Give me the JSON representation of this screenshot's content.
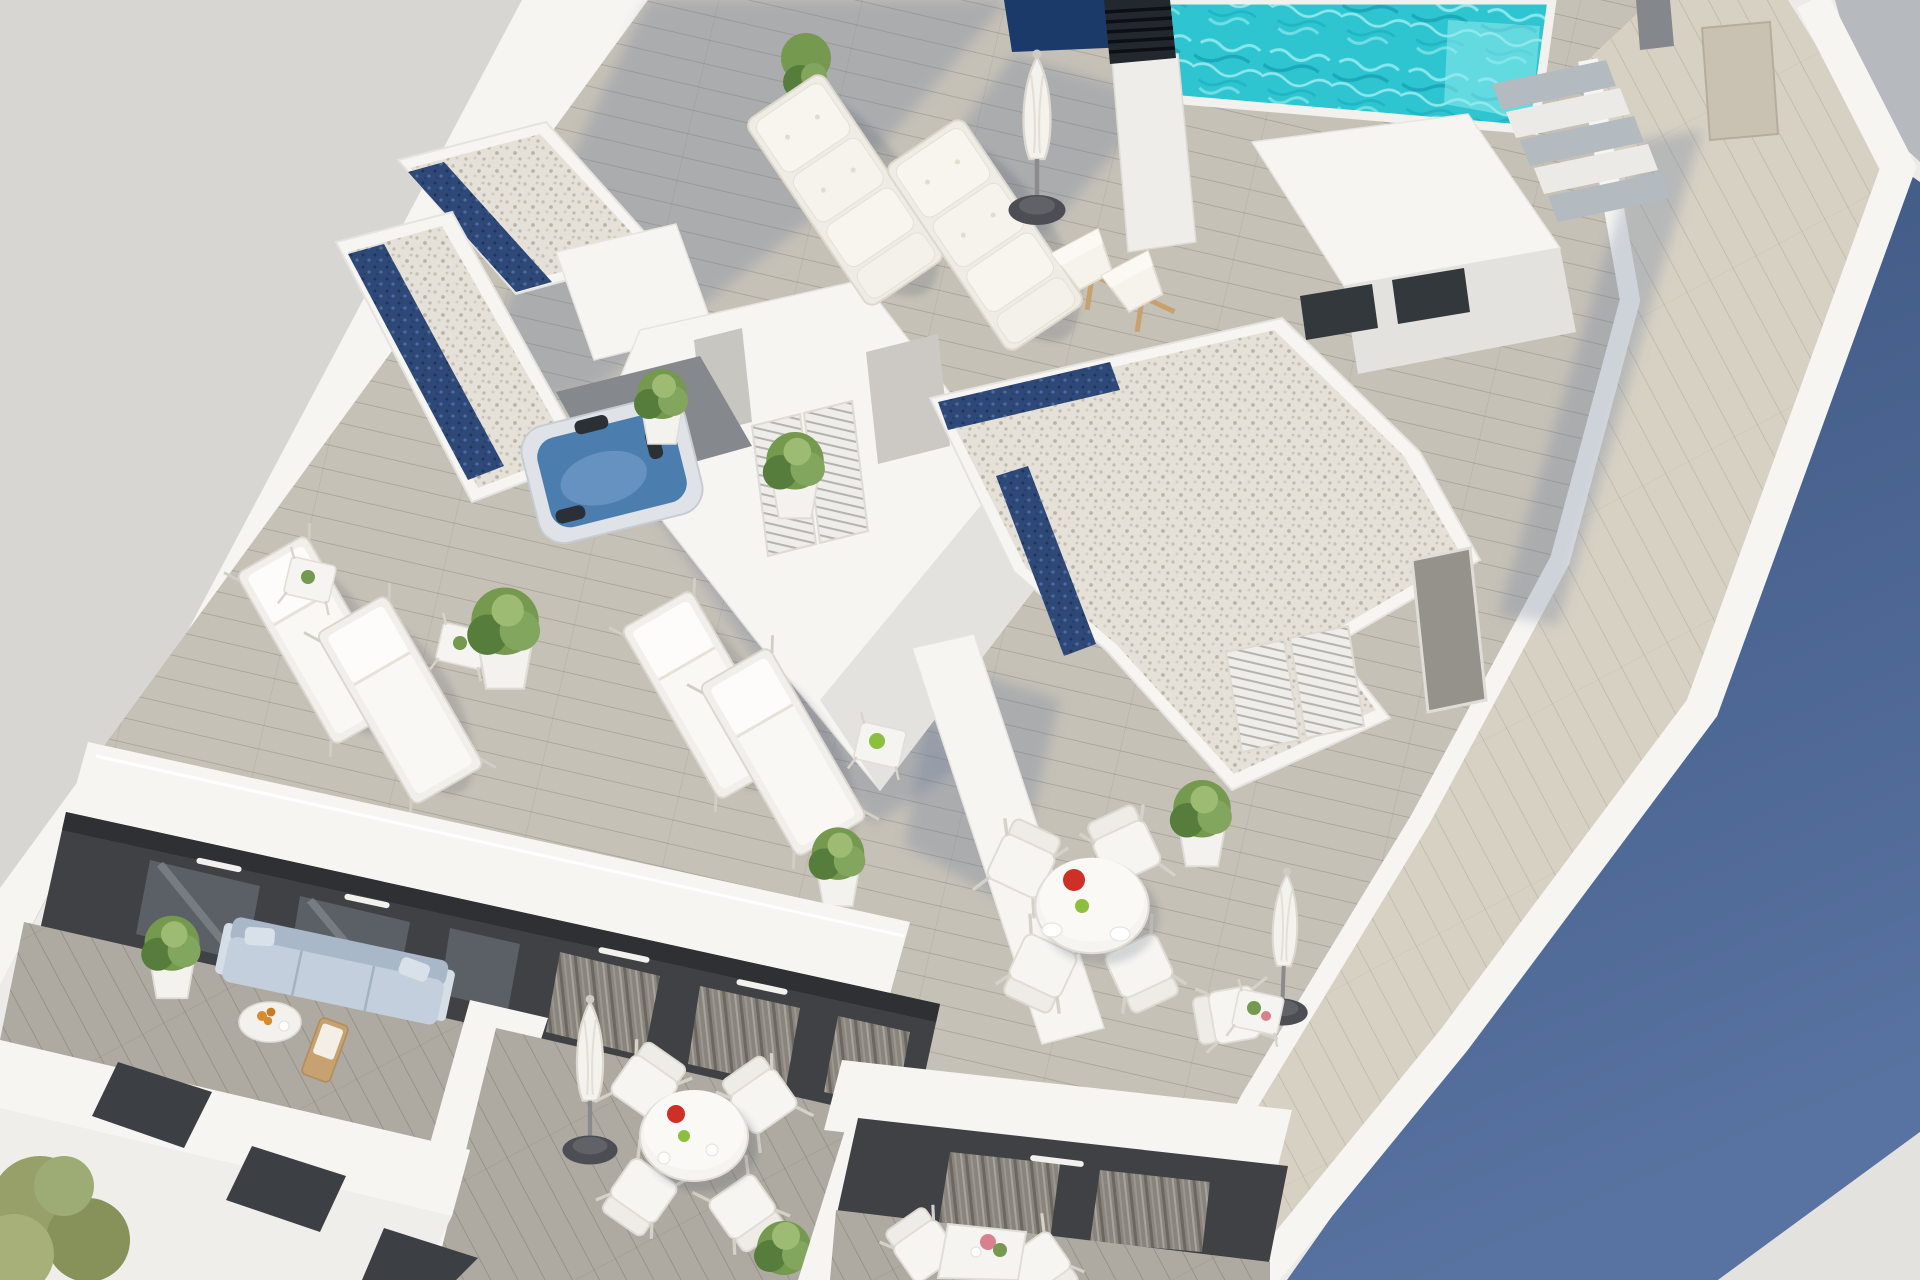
{
  "meta": {
    "title": "Aerial 3D architectural rendering of a rooftop terrace",
    "type": "architectural-visualization",
    "view": "rotated aerial axonometric",
    "time_of_day": "bright sunlight with long cast shadows"
  },
  "palette": {
    "ground": "#d8d6d3",
    "white_sun": "#f6f5f2",
    "white_soft": "#ecebe8",
    "wall_shade": "#e3e2df",
    "deck_field": "#c6c1b7",
    "deck_balcony": "#aeaaa1",
    "walkway": "#d7d1c4",
    "gravel": "#e5e1d8",
    "skylight_navy": "#2e4878",
    "pool_water": "#2ec5d1",
    "pool_light": "#9cf0f2",
    "pool_deep": "#17a3b4",
    "pool_overflow_navy": "#1c3a69",
    "jacuzzi_water": "#4b7eae",
    "shadow_cast": "#5a6f96",
    "shadow_blue_top": "#3d5681",
    "shadow_blue_bottom": "#5872a1",
    "corner_gray": "#b6b9be",
    "facade_charcoal": "#3f4145",
    "glass_door": "#5a6066",
    "curtain": "#8a857c",
    "door_beige": "#c9c2b2",
    "door_gray": "#95928c",
    "sofa_body": "#c3cfdc",
    "sofa_back": "#a9b8c8",
    "plant_green": "#74994f",
    "plant_dark": "#567d3c",
    "plant_olive": "#98a06a",
    "wood": "#c7a170",
    "tomato": "#ce2f26",
    "apple": "#8cbf3e",
    "orange_fruit": "#d88a2c",
    "flower_pink": "#d9808e",
    "umbrella_base": "#4d4e53",
    "chimney_dark": "#23272e",
    "tread_gray": "#b3bac0"
  },
  "scene": {
    "areas": [
      {
        "name": "street-ground",
        "label": "empty paved ground at upper left"
      },
      {
        "name": "rooftop-deck",
        "label": "main rooftop terrace with wood planking"
      },
      {
        "name": "pool-deck",
        "label": "swimming pool zone at top right"
      },
      {
        "name": "dining-terrace",
        "label": "roof terrace with round dining set"
      },
      {
        "name": "right-walkway",
        "label": "plank walkway along right parapet"
      },
      {
        "name": "private-balconies",
        "label": "three lower-floor balconies at bottom"
      },
      {
        "name": "shadowed-roof",
        "label": "blue cast shadow on neighbouring roof, right side"
      }
    ],
    "objects": [
      {
        "name": "swimming-pool",
        "label": "turquoise pool with rippled water"
      },
      {
        "name": "pool-infinity-edge",
        "label": "dark navy overflow edge"
      },
      {
        "name": "chimney",
        "label": "louvered dark chimney on white flue"
      },
      {
        "name": "pool-steps",
        "label": "white stair with gray treads"
      },
      {
        "name": "pool-house",
        "label": "white cube with dark windows"
      },
      {
        "name": "jacuzzi",
        "label": "square hot tub with blue water"
      },
      {
        "name": "gravel-roofs",
        "label": "pebble-topped roof volumes with navy skylight strips"
      },
      {
        "name": "stairwell-volume",
        "label": "large white angular stair volume"
      },
      {
        "name": "louvered-shutters",
        "label": "white louvered shutter doors"
      },
      {
        "name": "plush-loungers",
        "label": "two cushioned sun loungers"
      },
      {
        "name": "sling-loungers",
        "label": "four white sling sun loungers"
      },
      {
        "name": "deck-chairs",
        "label": "two wooden folding deck chairs"
      },
      {
        "name": "closed-umbrellas",
        "label": "three closed white parasols with round bases"
      },
      {
        "name": "round-dining-sets",
        "label": "two round white tables with tomato plate, apple and chairs"
      },
      {
        "name": "square-tables",
        "label": "small white side tables with plants"
      },
      {
        "name": "planters",
        "label": "white planters with green shrubs"
      },
      {
        "name": "topiary-tree",
        "label": "conical topiary in white pot"
      },
      {
        "name": "balcony-sofa",
        "label": "pale blue outdoor sofa"
      },
      {
        "name": "coffee-table-oranges",
        "label": "low table with bowl of oranges"
      },
      {
        "name": "curtained-doors",
        "label": "glass doors with gray curtains on dark facade"
      },
      {
        "name": "window-slits",
        "label": "dark parallelogram window openings in white facade"
      },
      {
        "name": "street-tree",
        "label": "olive-green tree at bottom left"
      }
    ]
  }
}
